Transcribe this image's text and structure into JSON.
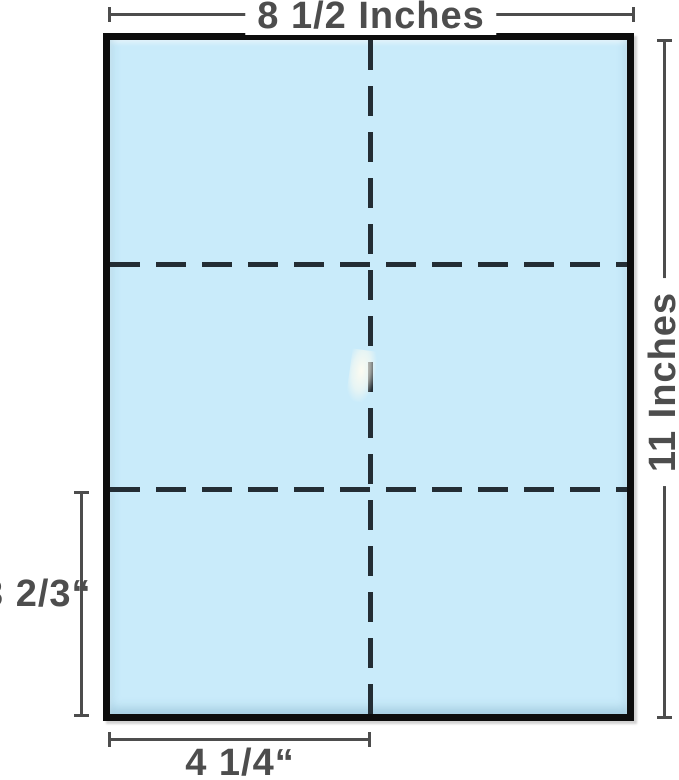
{
  "diagram": {
    "type": "paper-dimensions",
    "sheet": {
      "grid_rows": 3,
      "grid_columns": 2,
      "fill_color": "#c9ebfa",
      "border_color": "#0d0d0d",
      "fold_line_color": "#232d34",
      "fold_line_style": "dashed"
    },
    "dimension_style": {
      "line_color": "#4d4d4d",
      "text_color": "#4d4d4d"
    },
    "dimensions": {
      "width": {
        "label": "8 1/2 Inches",
        "position": "top"
      },
      "height": {
        "label": "11 Inches",
        "position": "right"
      },
      "panel_height": {
        "label": "3 2/3“",
        "position": "left"
      },
      "half_width": {
        "label": "4 1/4“",
        "position": "bottom"
      }
    }
  }
}
